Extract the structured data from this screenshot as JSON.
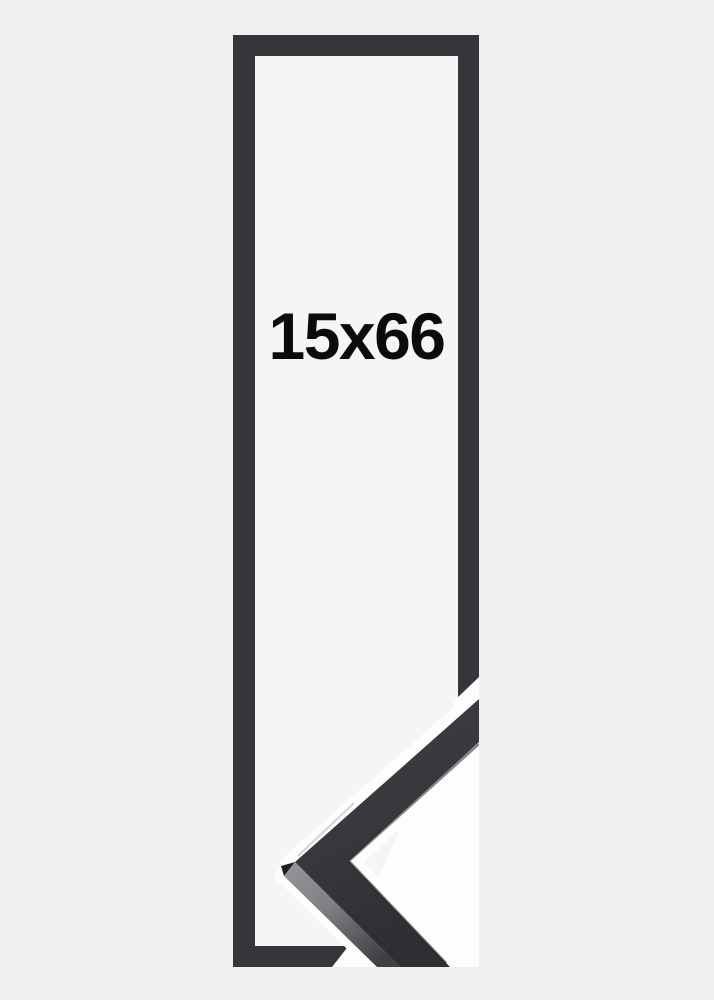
{
  "page": {
    "background_color": "#f0f0f1"
  },
  "frame_preview": {
    "size_label": "15x66",
    "frame_color": "#353639",
    "interior_color": "#f5f5f6",
    "detail_background_color": "#fdfdfd",
    "moulding_color": "#3a3b3e",
    "label_color": "#0b0b0c"
  }
}
